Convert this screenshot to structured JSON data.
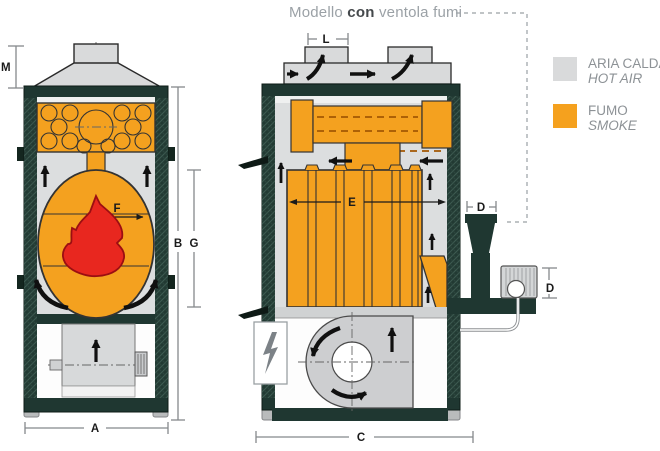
{
  "title": {
    "prefix": "Modello ",
    "bold": "con",
    "suffix": " ventola fumi"
  },
  "legend": {
    "items": [
      {
        "label": "ARIA CALDA",
        "sublabel": "HOT AIR",
        "color": "#d9dadb"
      },
      {
        "label": "FUMO",
        "sublabel": "SMOKE",
        "color": "#f5a11e"
      }
    ]
  },
  "dimensions": {
    "m": "M",
    "l": "L",
    "a": "A",
    "b": "B",
    "g": "G",
    "c": "C",
    "e": "E",
    "f": "F",
    "d_width": "D",
    "d_height": "D"
  },
  "colors": {
    "hot_air_gray": "#d9dadb",
    "smoke_orange": "#f5a11e",
    "frame_dark": "#1f3731",
    "flame_red": "#e8271f"
  }
}
